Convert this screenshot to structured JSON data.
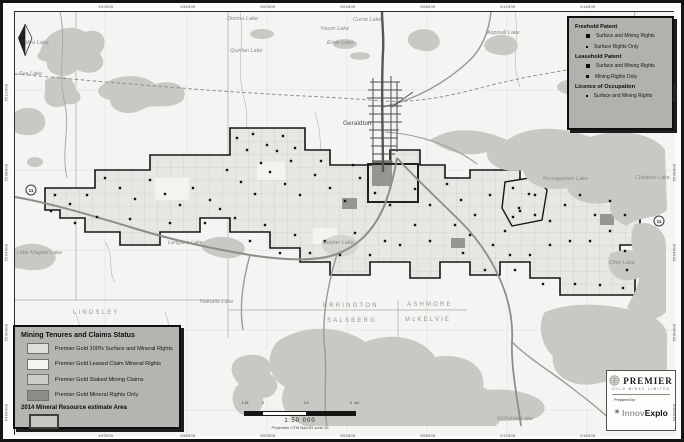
{
  "colors": {
    "paper": "#fbfbfa",
    "land": "#f4f4f2",
    "water": "#c8c8c5",
    "claims_fill": "#e7e7e4",
    "claims_outline": "#161616",
    "mineral_rights_only": "#96968f",
    "legend_bg": "#b4b4b1",
    "marker": "#141414"
  },
  "legend_claims": {
    "title": "Mining Tenures and Claims Status",
    "items": [
      {
        "label": "Premier Gold 100% Surface and Mineral Rights",
        "swatch": "#dededa"
      },
      {
        "label": "Premier Gold Leased Claim Mineral Rights",
        "swatch": "#f4f4f1"
      },
      {
        "label": "Premier Gold Staked Mining Claims",
        "swatch": "#ccccc8"
      },
      {
        "label": "Premier Gold Mineral Rights Only",
        "swatch": "#8c8c88"
      }
    ],
    "resource_label": "2014 Mineral Resource estimate Area"
  },
  "legend_tenure": {
    "sections": [
      {
        "title": "Freehold Patent",
        "items": [
          {
            "marker": "square-large",
            "label": "Surface and Mining Rights"
          },
          {
            "marker": "dot",
            "label": "Surface Rights Only"
          }
        ]
      },
      {
        "title": "Leasehold Patent",
        "items": [
          {
            "marker": "square-large",
            "label": "Surface and Mining Rights"
          },
          {
            "marker": "square-small",
            "label": "Mining Rights Only"
          }
        ]
      },
      {
        "title": "Licence of Occupation",
        "items": [
          {
            "marker": "dot-small",
            "label": "Surface and Mining Rights"
          }
        ]
      }
    ]
  },
  "scale": {
    "ratio": "1:50 000",
    "projection": "Projection UTM Nad 83 zone 16",
    "ticks": [
      "1.25",
      "0",
      "2.5",
      "5"
    ],
    "unit": "km"
  },
  "logo": {
    "company": "PREMIER",
    "company_sub": "GOLD MINES LIMITED",
    "prepared_by": "Prepared by:",
    "preparer_gray": "Innov",
    "preparer_bold": "Explo"
  },
  "map": {
    "town": {
      "name": "Geraldton",
      "x": 328,
      "y": 113
    },
    "lakes": [
      {
        "name": "Dionno Lake",
        "x": 212,
        "y": 8
      },
      {
        "name": "Quinlan Lake",
        "x": 215,
        "y": 40
      },
      {
        "name": "Yourin Lake",
        "x": 305,
        "y": 18
      },
      {
        "name": "Currie Lake",
        "x": 338,
        "y": 9
      },
      {
        "name": "Ernie Lake",
        "x": 312,
        "y": 32
      },
      {
        "name": "Aspinall Lake",
        "x": 472,
        "y": 22
      },
      {
        "name": "Jethro Lake",
        "x": 5,
        "y": 32
      },
      {
        "name": "Eva Lake",
        "x": 4,
        "y": 63
      },
      {
        "name": "Kenogamisis Lake",
        "x": 528,
        "y": 168
      },
      {
        "name": "Crabtree Lake",
        "x": 620,
        "y": 167
      },
      {
        "name": "Clive Lake",
        "x": 594,
        "y": 252
      },
      {
        "name": "Mosher Lake",
        "x": 307,
        "y": 232
      },
      {
        "name": "Lengane Lake",
        "x": 153,
        "y": 232
      },
      {
        "name": "Little Magnet Lake",
        "x": 2,
        "y": 242
      },
      {
        "name": "Nakotila Lake",
        "x": 185,
        "y": 291
      },
      {
        "name": "McKelvie Lake",
        "x": 482,
        "y": 408
      }
    ],
    "townships": [
      {
        "name": "LINDSLEY",
        "x": 58,
        "y": 302
      },
      {
        "name": "PARENT",
        "x": 65,
        "y": 330
      },
      {
        "name": "ERRINGTON",
        "x": 308,
        "y": 295
      },
      {
        "name": "ASHMORE",
        "x": 392,
        "y": 294
      },
      {
        "name": "SALSBERG",
        "x": 312,
        "y": 310
      },
      {
        "name": "McKELVIE",
        "x": 390,
        "y": 309
      }
    ],
    "highway_shields": [
      {
        "label": "11",
        "x": 16,
        "y": 178
      },
      {
        "label": "11",
        "x": 644,
        "y": 209
      }
    ],
    "markers": [
      [
        222,
        126
      ],
      [
        238,
        122
      ],
      [
        252,
        133
      ],
      [
        268,
        124
      ],
      [
        280,
        136
      ],
      [
        232,
        138
      ],
      [
        262,
        139
      ],
      [
        40,
        183
      ],
      [
        55,
        192
      ],
      [
        72,
        183
      ],
      [
        90,
        166
      ],
      [
        105,
        176
      ],
      [
        120,
        187
      ],
      [
        135,
        168
      ],
      [
        150,
        182
      ],
      [
        165,
        193
      ],
      [
        178,
        176
      ],
      [
        195,
        188
      ],
      [
        82,
        205
      ],
      [
        115,
        207
      ],
      [
        155,
        211
      ],
      [
        190,
        211
      ],
      [
        205,
        197
      ],
      [
        60,
        211
      ],
      [
        36,
        199
      ],
      [
        212,
        158
      ],
      [
        226,
        170
      ],
      [
        240,
        182
      ],
      [
        255,
        160
      ],
      [
        270,
        172
      ],
      [
        285,
        183
      ],
      [
        300,
        163
      ],
      [
        315,
        176
      ],
      [
        330,
        189
      ],
      [
        345,
        166
      ],
      [
        360,
        181
      ],
      [
        375,
        193
      ],
      [
        338,
        153
      ],
      [
        306,
        149
      ],
      [
        276,
        149
      ],
      [
        246,
        151
      ],
      [
        220,
        206
      ],
      [
        250,
        213
      ],
      [
        280,
        223
      ],
      [
        310,
        229
      ],
      [
        340,
        221
      ],
      [
        370,
        229
      ],
      [
        235,
        229
      ],
      [
        265,
        241
      ],
      [
        295,
        241
      ],
      [
        325,
        243
      ],
      [
        355,
        243
      ],
      [
        385,
        233
      ],
      [
        400,
        213
      ],
      [
        415,
        193
      ],
      [
        415,
        229
      ],
      [
        400,
        177
      ],
      [
        432,
        172
      ],
      [
        446,
        188
      ],
      [
        460,
        203
      ],
      [
        475,
        183
      ],
      [
        490,
        219
      ],
      [
        505,
        199
      ],
      [
        520,
        183
      ],
      [
        535,
        209
      ],
      [
        550,
        193
      ],
      [
        565,
        183
      ],
      [
        580,
        203
      ],
      [
        595,
        189
      ],
      [
        610,
        203
      ],
      [
        595,
        219
      ],
      [
        575,
        229
      ],
      [
        555,
        229
      ],
      [
        535,
        233
      ],
      [
        515,
        243
      ],
      [
        495,
        243
      ],
      [
        478,
        233
      ],
      [
        440,
        213
      ],
      [
        448,
        241
      ],
      [
        610,
        239
      ],
      [
        612,
        258
      ],
      [
        560,
        272
      ],
      [
        585,
        273
      ],
      [
        608,
        276
      ],
      [
        455,
        223
      ],
      [
        470,
        258
      ],
      [
        500,
        258
      ],
      [
        528,
        272
      ],
      [
        498,
        176
      ],
      [
        514,
        182
      ],
      [
        504,
        196
      ],
      [
        520,
        203
      ],
      [
        498,
        205
      ]
    ]
  },
  "frame": {
    "top_ticks": [
      {
        "x": 103,
        "label": "492000"
      },
      {
        "x": 185,
        "label": "496000"
      },
      {
        "x": 265,
        "label": "500000"
      },
      {
        "x": 345,
        "label": "504000"
      },
      {
        "x": 425,
        "label": "508000"
      },
      {
        "x": 505,
        "label": "512000"
      },
      {
        "x": 585,
        "label": "516000"
      }
    ],
    "side_ticks": [
      {
        "y": 90,
        "label": "5512000"
      },
      {
        "y": 170,
        "label": "5508000"
      },
      {
        "y": 250,
        "label": "5504000"
      },
      {
        "y": 330,
        "label": "5500000"
      },
      {
        "y": 410,
        "label": "5496000"
      }
    ]
  }
}
